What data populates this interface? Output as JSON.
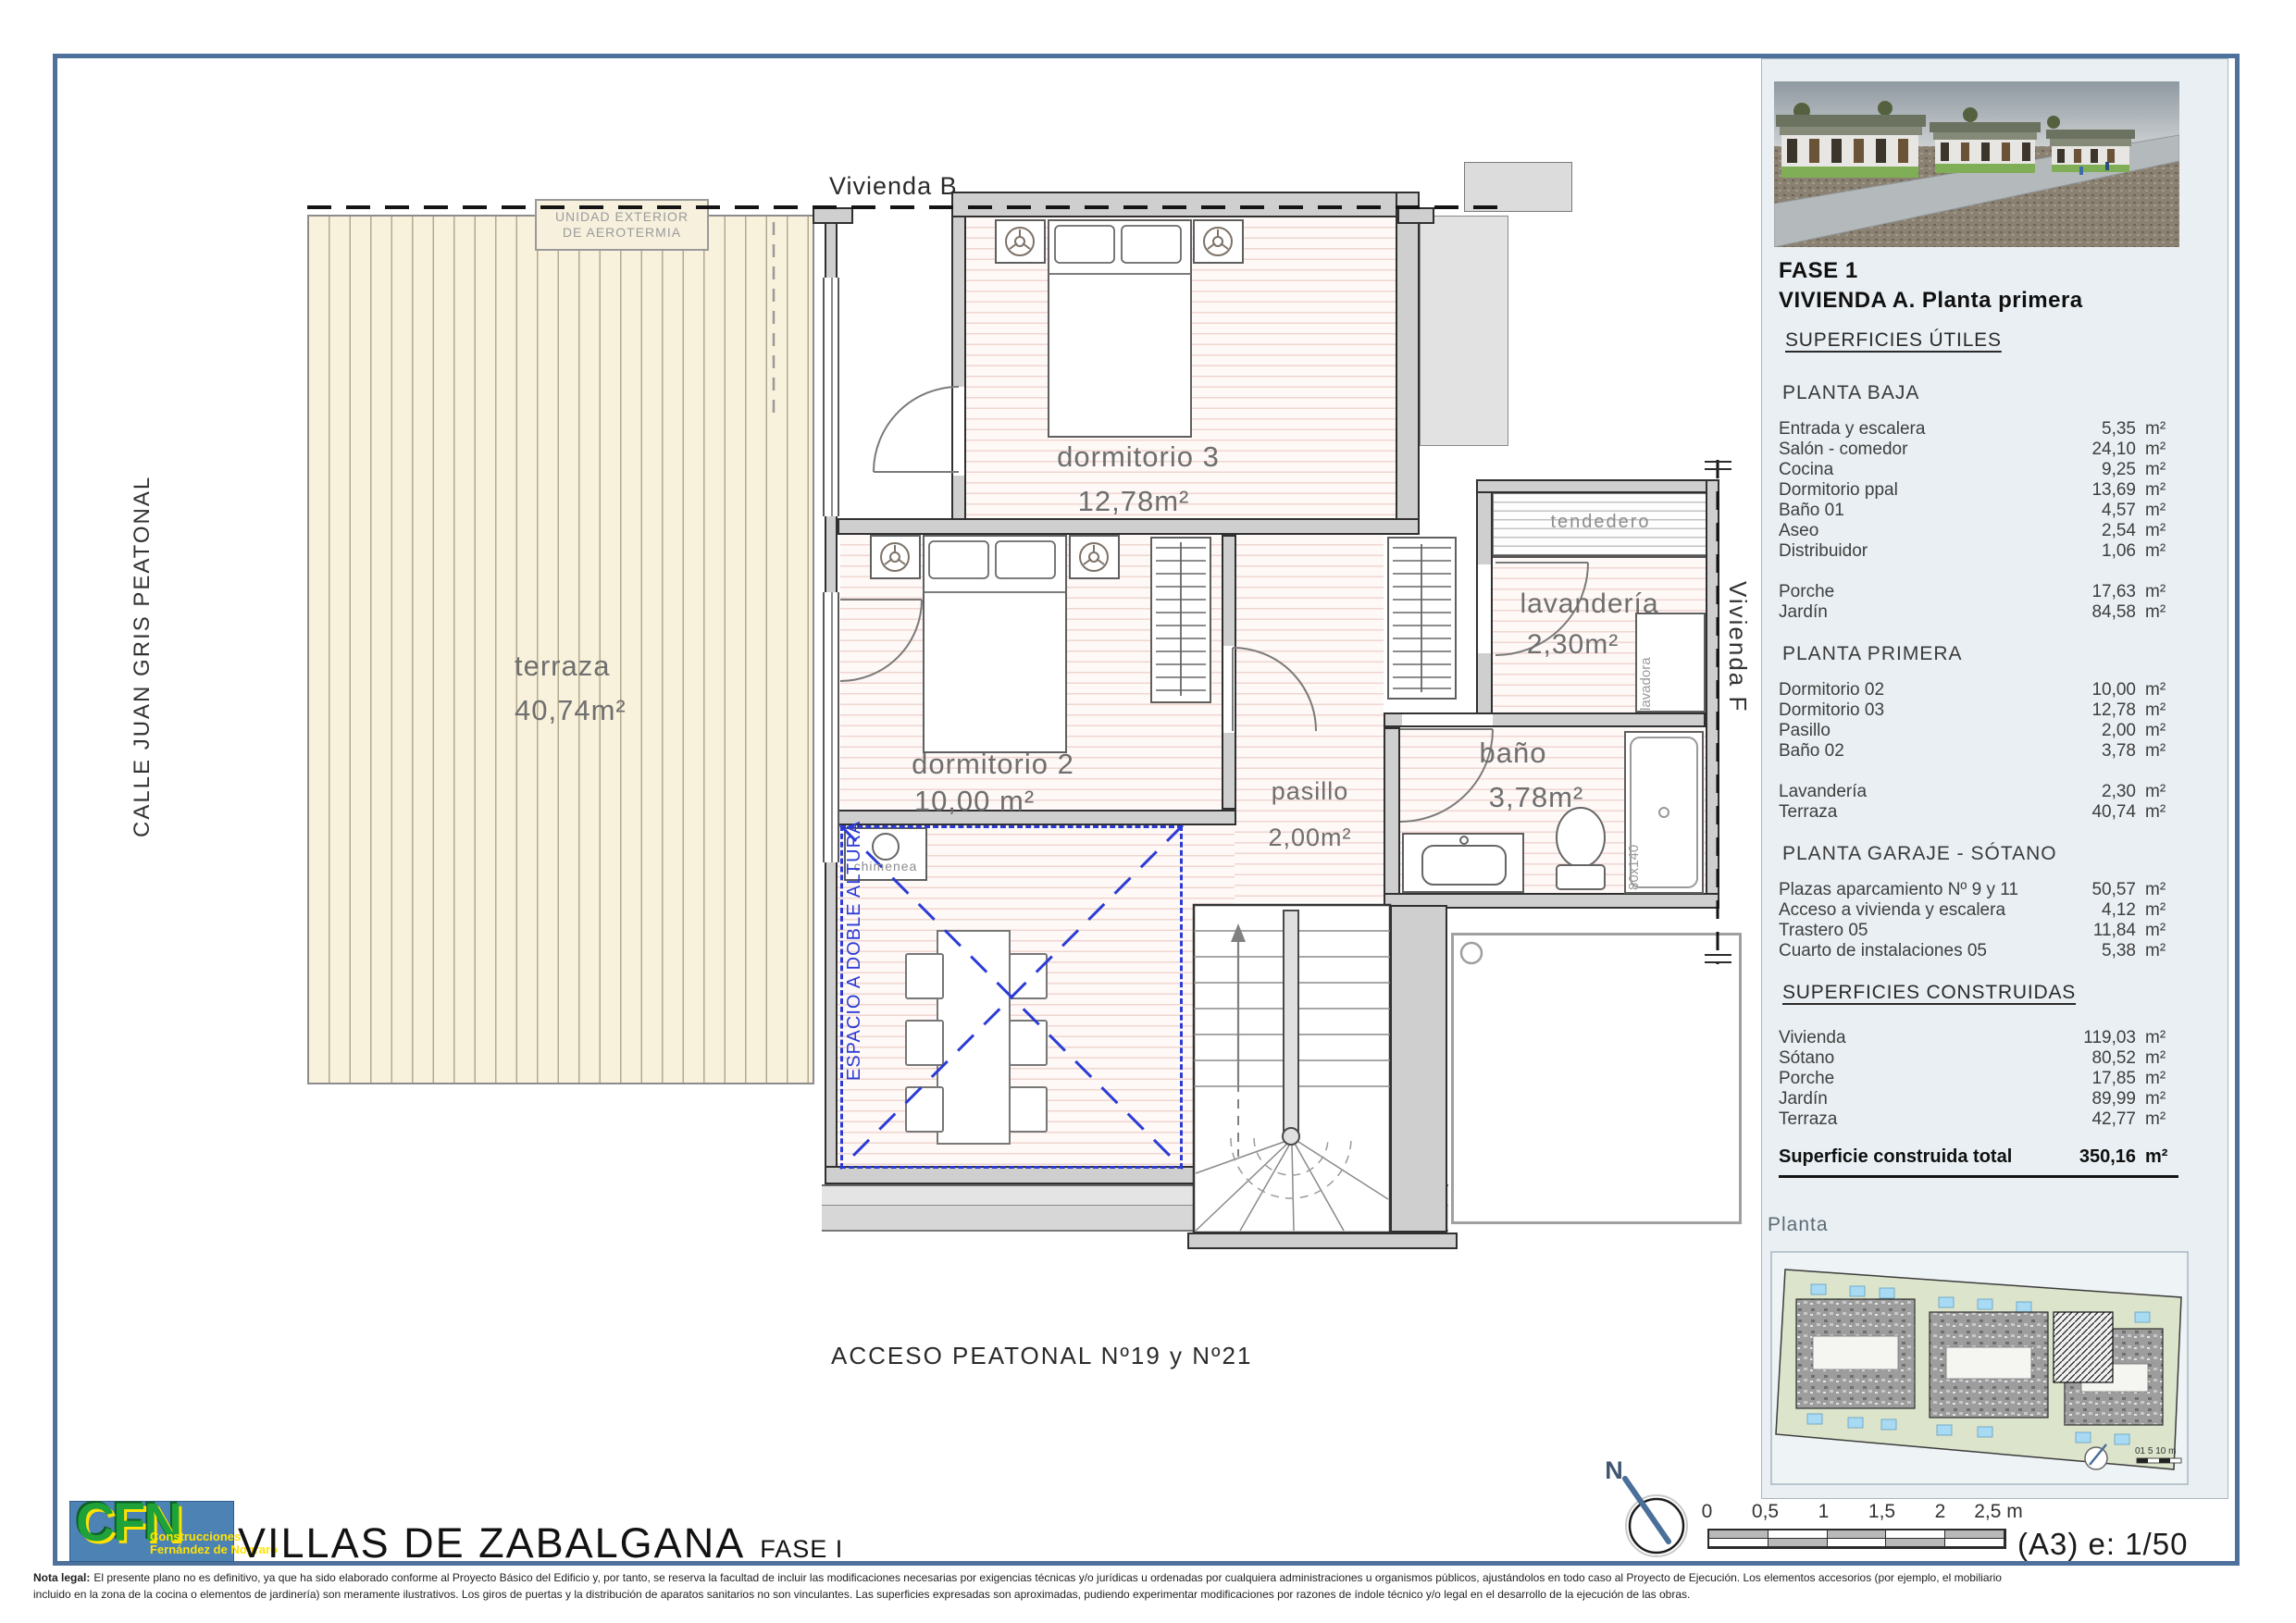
{
  "doc": {
    "title": "VILLAS DE ZABALGANA",
    "title_suffix": "FASE I",
    "scale_note": "(A3) e: 1/50",
    "north_label": "N",
    "scalebar_ticks": [
      "0",
      "0,5",
      "1",
      "1,5",
      "2",
      "2,5 m"
    ],
    "legal": {
      "label": "Nota legal:",
      "line1": "El presente plano no es definitivo, ya que ha sido elaborado conforme al Proyecto Básico del Edificio y, por tanto, se reserva la facultad de incluir las modificaciones necesarias por exigencias técnicas y/o jurídicas u ordenadas por cualquiera administraciones u organismos públicos, ajustándolos en todo caso al Proyecto de Ejecución. Los elementos accesorios (por ejemplo, el mobiliario",
      "line2": "incluido en la zona de la cocina o elementos de jardinería) son meramente ilustrativos. Los giros de puertas y la distribución de aparatos sanitarios no son vinculantes. Las superficies expresadas son aproximadas, pudiendo experimentar modificaciones por razones de índole técnico y/o legal en el desarrollo de la ejecución de las obras."
    }
  },
  "logo": {
    "letters": "CFN",
    "line1": "Construcciones",
    "line2": "Fernández de Nograro"
  },
  "plan": {
    "neighbor_top": "Vivienda B",
    "neighbor_right": "Vivienda F",
    "street_left": "CALLE JUAN GRIS PEATONAL",
    "access_label": "ACCESO  PEATONAL Nº19 y Nº21",
    "aerotermia": {
      "line1": "UNIDAD EXTERIOR",
      "line2": "DE AEROTERMIA"
    },
    "rooms": {
      "terraza": {
        "name": "terraza",
        "area": "40,74m²"
      },
      "dorm3": {
        "name": "dormitorio 3",
        "area": "12,78m²"
      },
      "dorm2": {
        "name": "dormitorio 2",
        "area": "10,00 m²"
      },
      "pasillo": {
        "name": "pasillo",
        "area": "2,00m²"
      },
      "bano": {
        "name": "baño",
        "area": "3,78m²"
      },
      "lavanderia": {
        "name": "lavandería",
        "area": "2,30m²"
      },
      "tendedero": {
        "name": "tendedero"
      }
    },
    "annotations": {
      "double_height": "ESPACIO A DOBLE ALTURA",
      "chimenea": "chimenea",
      "lavadora": "lavadora",
      "shower_size": "80x140"
    }
  },
  "panel": {
    "phase": "FASE 1",
    "title": "VIVIENDA A. Planta primera",
    "useful_header": "SUPERFICIES ÚTILES",
    "groups": [
      {
        "heading": "PLANTA BAJA",
        "rows": [
          {
            "label": "Entrada y escalera",
            "value": "5,35",
            "unit": "m²"
          },
          {
            "label": "Salón - comedor",
            "value": "24,10",
            "unit": "m²"
          },
          {
            "label": "Cocina",
            "value": "9,25",
            "unit": "m²"
          },
          {
            "label": "Dormitorio ppal",
            "value": "13,69",
            "unit": "m²"
          },
          {
            "label": "Baño 01",
            "value": "4,57",
            "unit": "m²"
          },
          {
            "label": "Aseo",
            "value": "2,54",
            "unit": "m²"
          },
          {
            "label": "Distribuidor",
            "value": "1,06",
            "unit": "m²"
          },
          {
            "label": "",
            "value": "",
            "unit": ""
          },
          {
            "label": "Porche",
            "value": "17,63",
            "unit": "m²"
          },
          {
            "label": "Jardín",
            "value": "84,58",
            "unit": "m²"
          }
        ]
      },
      {
        "heading": "PLANTA PRIMERA",
        "rows": [
          {
            "label": "Dormitorio 02",
            "value": "10,00",
            "unit": "m²"
          },
          {
            "label": "Dormitorio 03",
            "value": "12,78",
            "unit": "m²"
          },
          {
            "label": "Pasillo",
            "value": "2,00",
            "unit": "m²"
          },
          {
            "label": "Baño 02",
            "value": "3,78",
            "unit": "m²"
          },
          {
            "label": "",
            "value": "",
            "unit": ""
          },
          {
            "label": "Lavandería",
            "value": "2,30",
            "unit": "m²"
          },
          {
            "label": "Terraza",
            "value": "40,74",
            "unit": "m²"
          }
        ]
      },
      {
        "heading": "PLANTA GARAJE - SÓTANO",
        "rows": [
          {
            "label": "Plazas aparcamiento Nº 9 y 11",
            "value": "50,57",
            "unit": "m²"
          },
          {
            "label": "Acceso a vivienda y escalera",
            "value": "4,12",
            "unit": "m²"
          },
          {
            "label": "Trastero 05",
            "value": "11,84",
            "unit": "m²"
          },
          {
            "label": "Cuarto de instalaciones 05",
            "value": "5,38",
            "unit": "m²"
          }
        ]
      }
    ],
    "built_header": "SUPERFICIES CONSTRUIDAS",
    "built_rows": [
      {
        "label": "Vivienda",
        "value": "119,03",
        "unit": "m²"
      },
      {
        "label": "Sótano",
        "value": "80,52",
        "unit": "m²"
      },
      {
        "label": "Porche",
        "value": "17,85",
        "unit": "m²"
      },
      {
        "label": "Jardín",
        "value": "89,99",
        "unit": "m²"
      },
      {
        "label": "Terraza",
        "value": "42,77",
        "unit": "m²"
      }
    ],
    "total": {
      "label": "Superficie construida total",
      "value": "350,16",
      "unit": "m²"
    },
    "planta_label": "Planta",
    "minimap_scale": "01  5  10 m"
  }
}
